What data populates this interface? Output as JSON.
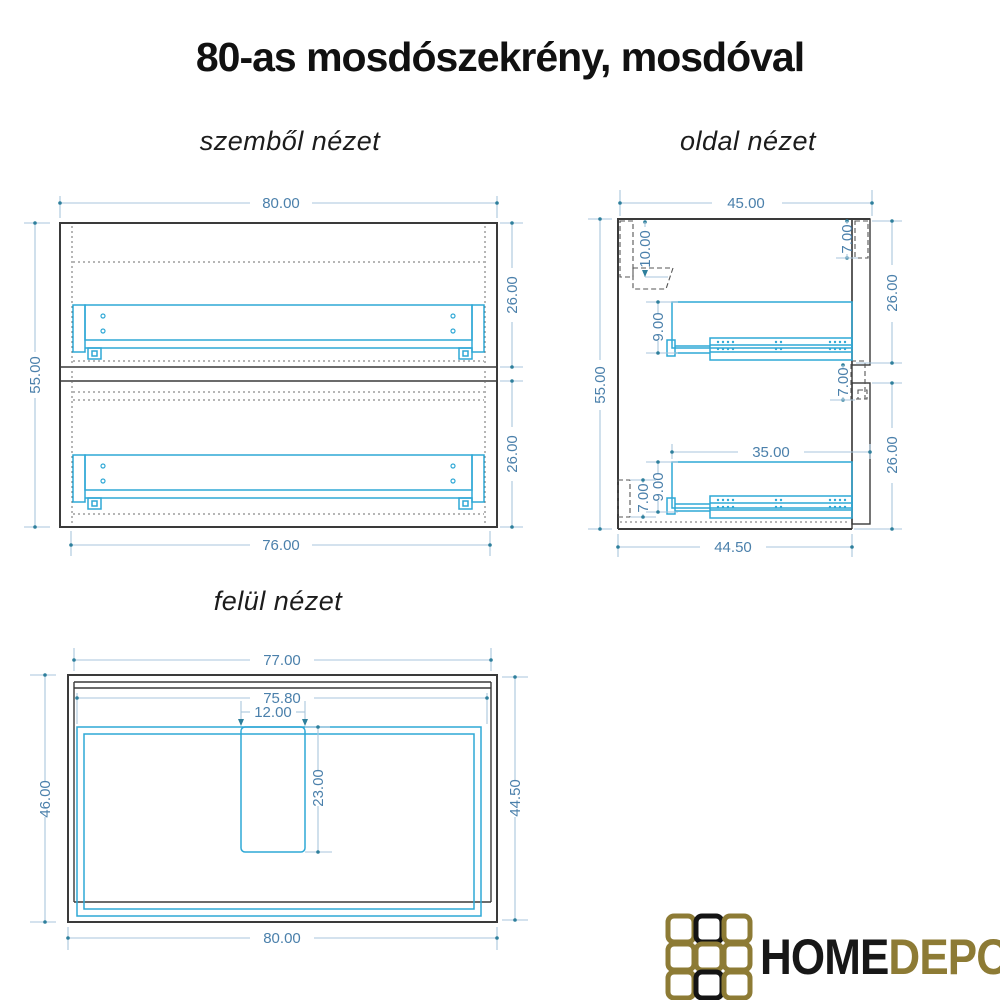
{
  "title": "80-as mosdószekrény, mosdóval",
  "views": {
    "front": {
      "label": "szemből nézet",
      "dims": {
        "overall_width": "80.00",
        "overall_height": "55.00",
        "upper_drawer_height": "26.00",
        "lower_drawer_height": "26.00",
        "inner_width": "76.00"
      }
    },
    "side": {
      "label": "oldal nézet",
      "dims": {
        "overall_depth": "45.00",
        "overall_height": "55.00",
        "hanger_offset": "10.00",
        "top_rail_height": "7.00",
        "upper_front_height": "26.00",
        "mid_rail_height": "7.00",
        "upper_slide_height": "9.00",
        "slide_length": "35.00",
        "lower_slide_height": "9.00",
        "bottom_rail_height": "7.00",
        "lower_front_height": "26.00",
        "carcass_depth": "44.50"
      }
    },
    "top": {
      "label": "felül nézet",
      "dims": {
        "cabinet_width": "77.00",
        "inner_width": "75.80",
        "cutout_width": "12.00",
        "cutout_depth": "23.00",
        "basin_depth": "46.00",
        "cabinet_depth": "44.50",
        "basin_width": "80.00"
      }
    }
  },
  "logo": {
    "word_primary": "HOME",
    "word_secondary": "DEPO"
  },
  "colors": {
    "outline": "#3a3a3a",
    "hidden_line": "#6e6e6e",
    "hardware_cyan": "#2fa8d6",
    "dimension_line": "#a9c6dc",
    "dimension_marker": "#2e7f9c",
    "dimension_text": "#4b80ab",
    "logo_gold": "#8d7b35",
    "logo_black": "#141414"
  }
}
